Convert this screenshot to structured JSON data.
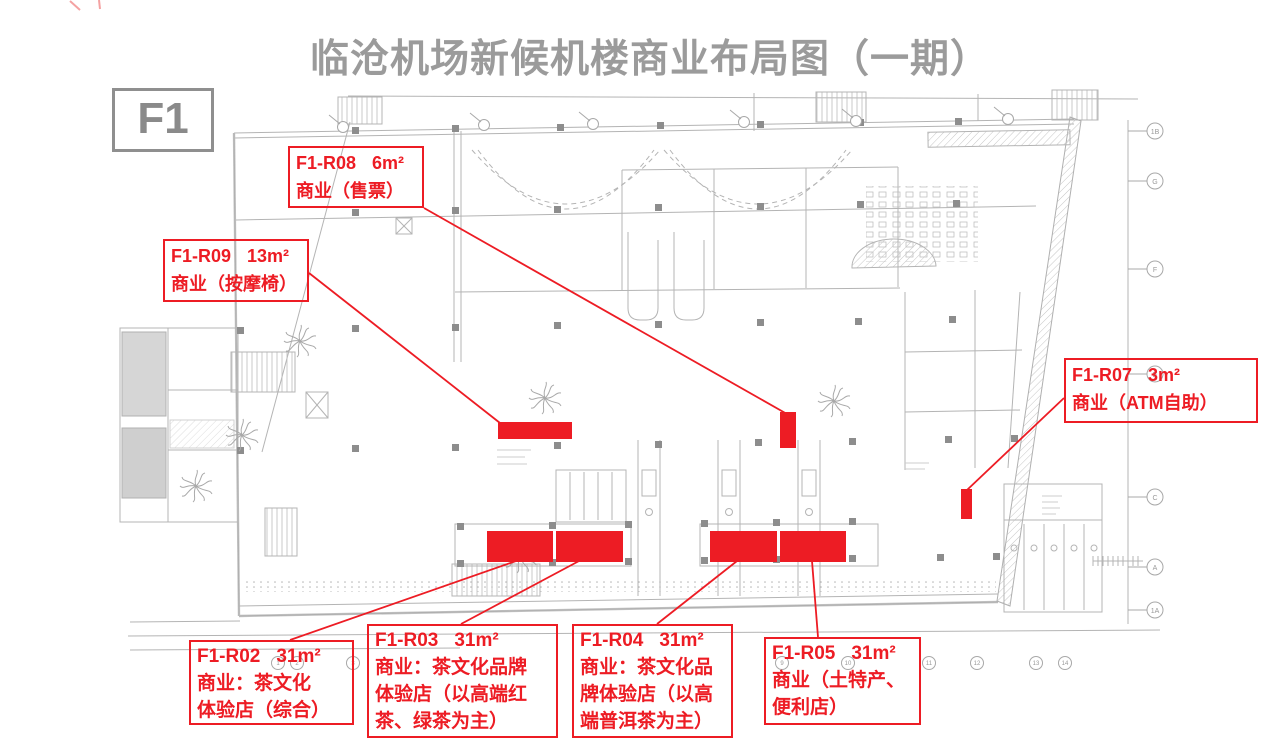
{
  "page": {
    "title": "临沧机场新候机楼商业布局图（一期）",
    "floor_label": "F1"
  },
  "colors": {
    "accent_red": "#ed1c24",
    "title_gray": "#9b9b9b",
    "plan_gray": "#b4b4b4"
  },
  "callouts": {
    "r08": {
      "code": "F1-R08",
      "area": "6m²",
      "desc": [
        "商业（售票）"
      ]
    },
    "r09": {
      "code": "F1-R09",
      "area": "13m²",
      "desc": [
        "商业（按摩椅）"
      ]
    },
    "r07": {
      "code": "F1-R07",
      "area": "3m²",
      "desc": [
        "商业（ATM自助）"
      ]
    },
    "r02": {
      "code": "F1-R02",
      "area": "31m²",
      "desc": [
        "商业：茶文化",
        "体验店（综合）"
      ]
    },
    "r03": {
      "code": "F1-R03",
      "area": "31m²",
      "desc": [
        "商业：茶文化品牌",
        "体验店（以高端红",
        "茶、绿茶为主）"
      ]
    },
    "r04": {
      "code": "F1-R04",
      "area": "31m²",
      "desc": [
        "商业：茶文化品",
        "牌体验店（以高",
        "端普洱茶为主）"
      ]
    },
    "r05": {
      "code": "F1-R05",
      "area": "31m²",
      "desc": [
        "商业（土特产、",
        "便利店）"
      ]
    }
  },
  "plan": {
    "grid_labels_bottom": [
      "1",
      "2",
      "3",
      "9",
      "10",
      "11",
      "12",
      "13",
      "14"
    ],
    "grid_labels_right": [
      "1B",
      "G",
      "F",
      "E",
      "C",
      "A",
      "1A"
    ]
  }
}
